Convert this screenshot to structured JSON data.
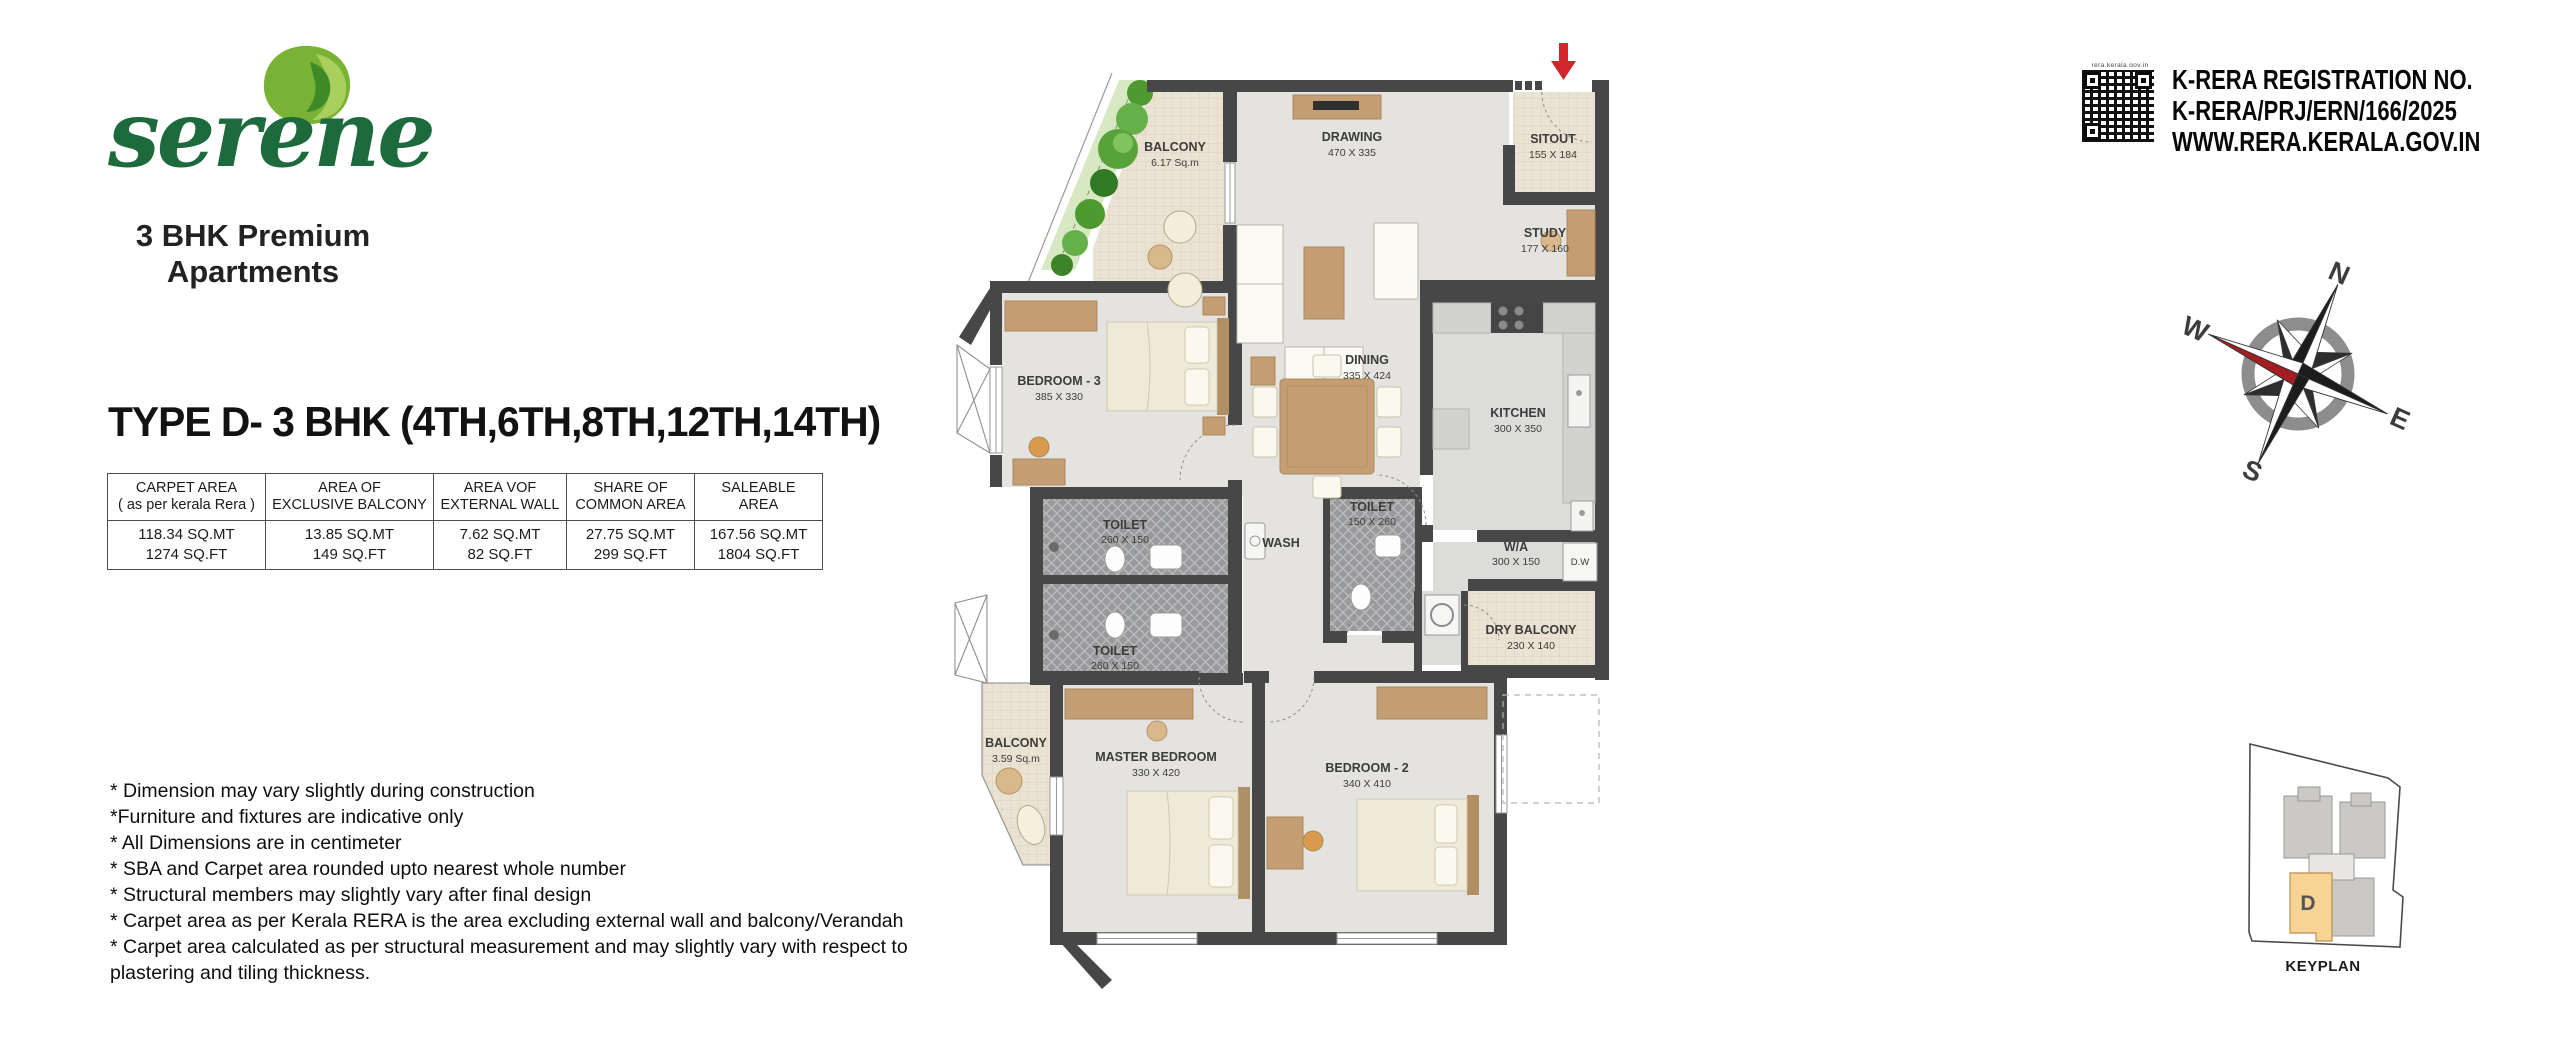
{
  "brand": {
    "name": "serene",
    "tagline_line1": "3 BHK Premium",
    "tagline_line2": "Apartments"
  },
  "plan_title": "TYPE D- 3 BHK (4TH,6TH,8TH,12TH,14TH)",
  "area_table": {
    "columns": [
      {
        "header_line1": "CARPET AREA",
        "header_line2": "( as per kerala Rera )",
        "value_sqmt": "118.34 SQ.MT",
        "value_sqft": "1274 SQ.FT"
      },
      {
        "header_line1": "AREA OF",
        "header_line2": "EXCLUSIVE BALCONY",
        "value_sqmt": "13.85 SQ.MT",
        "value_sqft": "149 SQ.FT"
      },
      {
        "header_line1": "AREA VOF",
        "header_line2": "EXTERNAL WALL",
        "value_sqmt": "7.62 SQ.MT",
        "value_sqft": "82 SQ.FT"
      },
      {
        "header_line1": "SHARE OF",
        "header_line2": "COMMON AREA",
        "value_sqmt": "27.75 SQ.MT",
        "value_sqft": "299 SQ.FT"
      },
      {
        "header_line1": "SALEABLE AREA",
        "header_line2": "",
        "value_sqmt": "167.56 SQ.MT",
        "value_sqft": "1804 SQ.FT"
      }
    ]
  },
  "notes": [
    "* Dimension may vary slightly during construction",
    "*Furniture and fixtures are indicative only",
    "* All Dimensions are in centimeter",
    "* SBA and Carpet area rounded upto nearest whole number",
    "* Structural members may slightly vary after final design",
    "* Carpet area as per Kerala RERA is the area excluding external wall and balcony/Verandah",
    "* Carpet area calculated as per structural measurement and may slightly vary with respect to plastering and tiling thickness."
  ],
  "rera": {
    "qr_caption": "rera.kerala.gov.in",
    "line1": "K-RERA REGISTRATION NO.",
    "line2": "K-RERA/PRJ/ERN/166/2025",
    "line3": "WWW.RERA.KERALA.GOV.IN"
  },
  "compass": {
    "north": "N",
    "east": "E",
    "south": "S",
    "west": "W"
  },
  "keyplan": {
    "label": "KEYPLAN",
    "highlighted_unit": "D"
  },
  "floor_plan": {
    "rooms": [
      {
        "name": "BALCONY",
        "dims": "6.17 Sq.m"
      },
      {
        "name": "DRAWING",
        "dims": "470 X 335"
      },
      {
        "name": "SITOUT",
        "dims": "155 X 184"
      },
      {
        "name": "STUDY",
        "dims": "177 X 160"
      },
      {
        "name": "BEDROOM - 3",
        "dims": "385 X 330"
      },
      {
        "name": "DINING",
        "dims": "335 X 424"
      },
      {
        "name": "KITCHEN",
        "dims": "300 X 350"
      },
      {
        "name": "TOILET",
        "dims": "260 X 150"
      },
      {
        "name": "WASH",
        "dims": ""
      },
      {
        "name": "TOILET",
        "dims": "150 X 260"
      },
      {
        "name": "TOILET",
        "dims": "260 X 150"
      },
      {
        "name": "W/A",
        "dims": "300 X 150"
      },
      {
        "name": "D.W",
        "dims": ""
      },
      {
        "name": "DRY BALCONY",
        "dims": "230 X 140"
      },
      {
        "name": "BALCONY",
        "dims": "3.59 Sq.m"
      },
      {
        "name": "MASTER BEDROOM",
        "dims": "330 X 420"
      },
      {
        "name": "BEDROOM - 2",
        "dims": "340 X 410"
      }
    ]
  },
  "colors": {
    "brand_green": "#1d6a3c",
    "wall": "#474747",
    "floor": "#e5e3df",
    "kitchen_floor": "#dcdcda",
    "balcony_tile": "#eae3d3",
    "toilet_tile": "#98999b",
    "wood": "#c49e72",
    "accent_red": "#d1262b",
    "keyplan_highlight": "#f7d494"
  }
}
